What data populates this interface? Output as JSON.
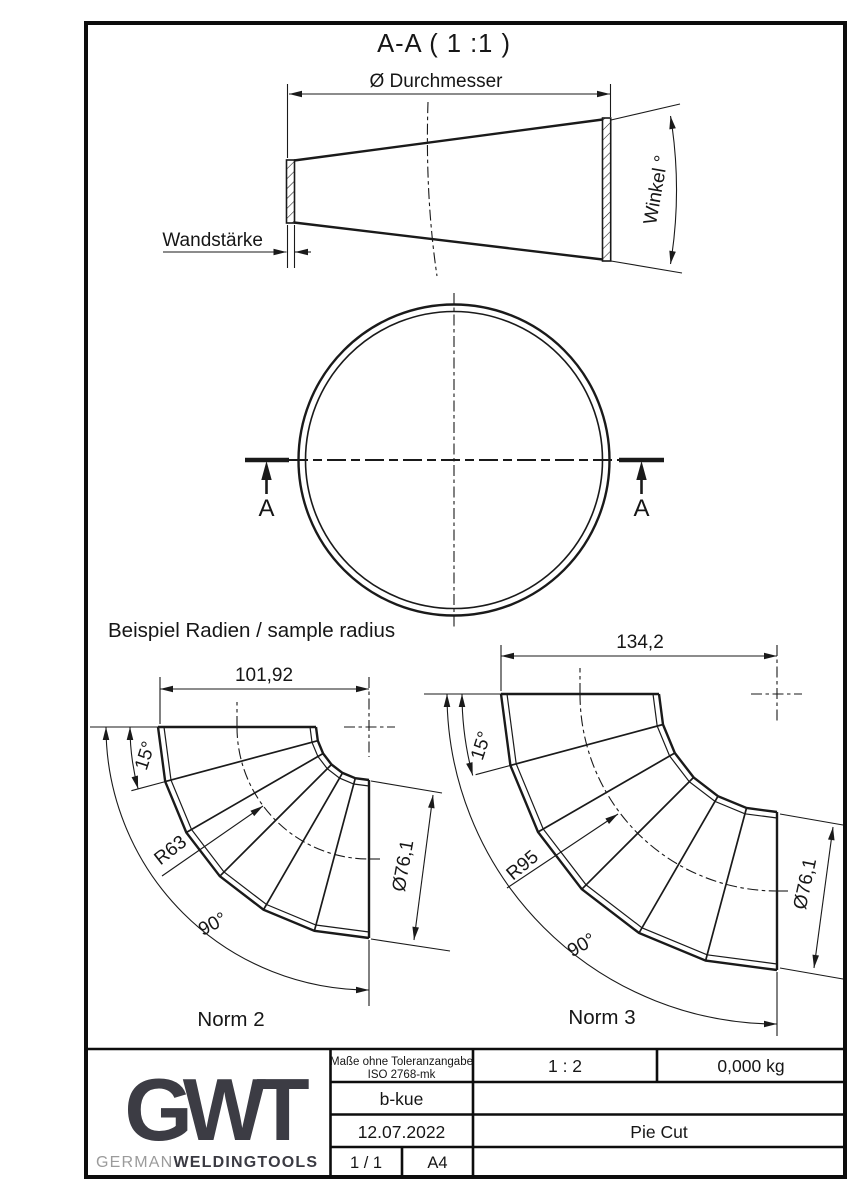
{
  "colors": {
    "ink": "#1a1a1a",
    "logo_dark": "#3c3c44",
    "logo_gray": "#9b9b9b"
  },
  "section_view": {
    "title": "A-A ( 1 :1 )",
    "diameter_label": "Ø Durchmesser",
    "wall_label": "Wandstärke",
    "angle_label": "Winkel °"
  },
  "plan_view": {
    "cut_label": "A"
  },
  "samples": {
    "heading": "Beispiel Radien / sample radius",
    "norm2": {
      "name": "Norm 2",
      "length": "101,92",
      "segment_angle": "15°",
      "bend_radius": "R63",
      "bend_angle": "90°",
      "diameter": "Ø76,1"
    },
    "norm3": {
      "name": "Norm 3",
      "length": "134,2",
      "segment_angle": "15°",
      "bend_radius": "R95",
      "bend_angle": "90°",
      "diameter": "Ø76,1"
    }
  },
  "title_block": {
    "tolerance_note_line1": "Maße ohne Toleranzangabe",
    "tolerance_note_line2": "ISO 2768-mk",
    "scale": "1 : 2",
    "weight": "0,000 kg",
    "author": "b-kue",
    "date": "12.07.2022",
    "drawing_title": "Pie Cut",
    "sheet": "1 / 1",
    "paper_format": "A4",
    "logo_text": "GWT",
    "brand_prefix": "GERMAN",
    "brand_suffix": "WELDINGTOOLS"
  }
}
